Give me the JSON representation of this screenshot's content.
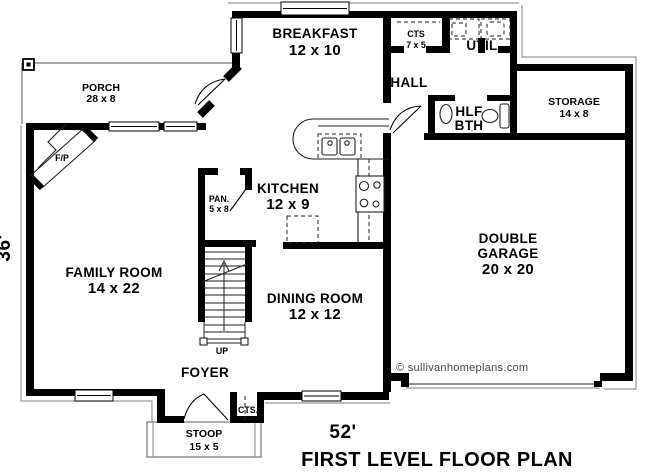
{
  "plan": {
    "title": "FIRST LEVEL FLOOR PLAN",
    "copyright": "© sullivanhomeplans.com",
    "width_dim": "52'",
    "height_dim": "36'"
  },
  "rooms": {
    "porch": {
      "name": "PORCH",
      "size": "28 x 8"
    },
    "breakfast": {
      "name": "BREAKFAST",
      "size": "12 x 10"
    },
    "cts_hall": {
      "name": "CTS",
      "size": "7 x 5"
    },
    "util": {
      "name": "UTIL"
    },
    "hall": {
      "name": "HALL"
    },
    "half_bath": {
      "line1": "HLF",
      "line2": "BTH"
    },
    "storage": {
      "name": "STORAGE",
      "size": "14 x 8"
    },
    "kitchen": {
      "name": "KITCHEN",
      "size": "12 x 9"
    },
    "pantry": {
      "name": "PAN.",
      "size": "5 x 8"
    },
    "family_room": {
      "name": "FAMILY ROOM",
      "size": "14 x 22"
    },
    "dining_room": {
      "name": "DINING ROOM",
      "size": "12 x 12"
    },
    "garage": {
      "line1": "DOUBLE",
      "line2": "GARAGE",
      "size": "20 x 20"
    },
    "foyer": {
      "name": "FOYER"
    },
    "cts_foyer": {
      "name": "CTS."
    },
    "stoop": {
      "name": "STOOP",
      "size": "15 x 5"
    }
  },
  "annotations": {
    "up": "UP",
    "fireplace": "F/P"
  },
  "colors": {
    "wall": "#000000",
    "outline": "#999999",
    "background": "#ffffff",
    "copyright_text": "#444444"
  }
}
